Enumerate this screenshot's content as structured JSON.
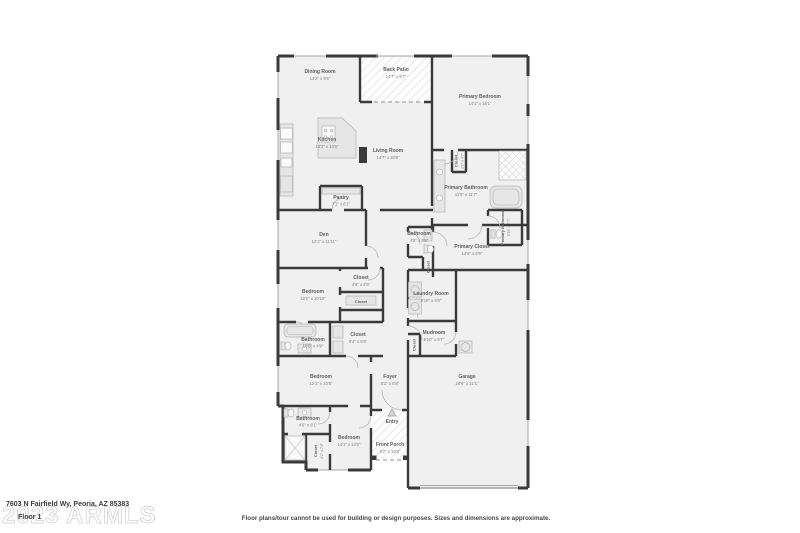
{
  "page": {
    "watermark": "2023 ARMLS",
    "address": "7603 N Fairfield Wy, Peoria, AZ 85383",
    "floor_label": "Floor 1",
    "disclaimer": "Floor plans/tour cannot be used for building or design purposes. Sizes and dimensions are approximate."
  },
  "colors": {
    "wall": "#3a3a3a",
    "floor": "#f0f0f0",
    "fixture": "#e6e6e6",
    "label_text": "#5e5e5e",
    "watermark": "#cccccc",
    "background": "#ffffff"
  },
  "icons": {
    "entry_marker": "entry-direction-triangle"
  },
  "rooms": {
    "dining": {
      "name": "Dining Room",
      "dims": "13'2\" x 9'6\""
    },
    "back_patio": {
      "name": "Back Patio",
      "dims": "14'7\" x 9'7\""
    },
    "primary_bedroom": {
      "name": "Primary Bedroom",
      "dims": "14'1\" x 16'1\""
    },
    "kitchen": {
      "name": "Kitchen",
      "dims": "14'2\" x 13'6\""
    },
    "living": {
      "name": "Living Room",
      "dims": "14'7\" x 20'9\""
    },
    "pantry": {
      "name": "Pantry",
      "dims": "7'1\" x 6'1\""
    },
    "primary_closet_small": {
      "name": "Closet",
      "dims": "2'1\" x 4'7\""
    },
    "primary_bathroom": {
      "name": "Primary Bathroom",
      "dims": "11'9\" x 11'7\""
    },
    "primary_bathroom_wc": {
      "name": "Primary Bathroom",
      "dims": "3'10\" x 7'7\""
    },
    "primary_closet": {
      "name": "Primary Closet",
      "dims": "14'6\" x 6'6\""
    },
    "den": {
      "name": "Den",
      "dims": "12'1\" x 11'11\""
    },
    "hall_bathroom": {
      "name": "Bathroom",
      "dims": "4'8\" x 9'8\""
    },
    "hall_closet": {
      "name": "Closet",
      "dims": ""
    },
    "laundry": {
      "name": "Laundry Room",
      "dims": "8'10\" x 6'6\""
    },
    "bedroom2": {
      "name": "Bedroom",
      "dims": "12'2\" x 10'10\""
    },
    "closet2": {
      "name": "Closet",
      "dims": "4'6\" x 2'6\""
    },
    "closet2b": {
      "name": "Closet",
      "dims": ""
    },
    "bathroom2": {
      "name": "Bathroom",
      "dims": "10'6\" x 4'9\""
    },
    "closet3": {
      "name": "Closet",
      "dims": "8'4\" x 5'5\""
    },
    "mudroom": {
      "name": "Mudroom",
      "dims": "5'10\" x 6'7\""
    },
    "mud_closet": {
      "name": "Closet",
      "dims": ""
    },
    "bedroom3": {
      "name": "Bedroom",
      "dims": "12'1\" x 10'8\""
    },
    "foyer": {
      "name": "Foyer",
      "dims": "6'2\" x 6'8\""
    },
    "garage": {
      "name": "Garage",
      "dims": "20'6\" x 21'1\""
    },
    "bathroom3": {
      "name": "Bathroom",
      "dims": "4'6\" x 8'1\""
    },
    "closet4": {
      "name": "Closet",
      "dims": "2'2\" x 7'2\""
    },
    "bedroom4": {
      "name": "Bedroom",
      "dims": "14'1\" x 13'0\""
    },
    "entry": {
      "name": "Entry",
      "dims": ""
    },
    "front_porch": {
      "name": "Front Porch",
      "dims": "8'2\" x 15'8\""
    }
  }
}
